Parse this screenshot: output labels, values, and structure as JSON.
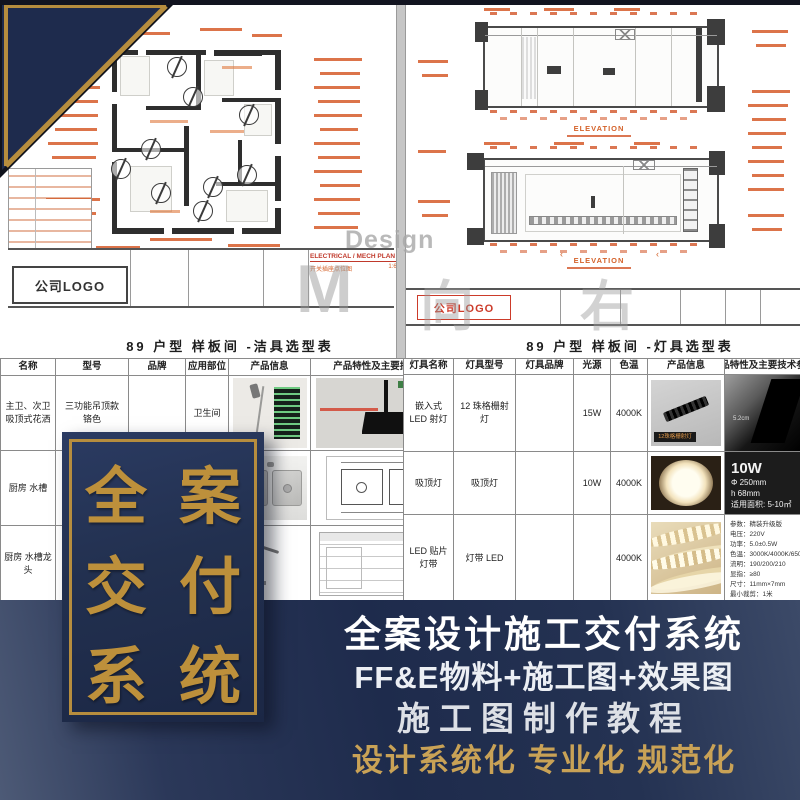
{
  "corner_banner": {
    "lines": [
      "全案",
      "交付",
      "系统"
    ],
    "navy": "#1e2b4d",
    "gold": "#bd903b"
  },
  "sheet_left": {
    "plan_title": "ELECTRICAL / MECH PLAN",
    "plan_subtitle": "开关插座点位图",
    "plan_scale": "1:60",
    "logo": "公司LOGO"
  },
  "sheet_right": {
    "elevation_label_1": "ELEVATION",
    "elevation_label_2": "ELEVATION",
    "logo": "公司LOGO"
  },
  "watermark": {
    "design": "Design",
    "glyphs": [
      "M",
      "向",
      "右"
    ]
  },
  "titles": {
    "sanitary": "89 户型 样板间 -洁具选型表",
    "lighting": "89 户型 样板间 -灯具选型表"
  },
  "sanitary_table": {
    "headers": [
      "名称",
      "型号",
      "品牌",
      "应用部位",
      "产品信息",
      "产品特性及主要技术参数"
    ],
    "rows": [
      {
        "name": "主卫、次卫 吸顶式花洒",
        "model": "三功能吊顶款 铬色",
        "brand": "",
        "location": "卫生间"
      },
      {
        "name": "厨房  水槽",
        "model": "",
        "brand": "",
        "location": ""
      },
      {
        "name": "厨房  水槽龙头",
        "model": "",
        "brand": "",
        "location": ""
      }
    ]
  },
  "lighting_table": {
    "headers": [
      "灯具名称",
      "灯具型号",
      "灯具品牌",
      "光源",
      "色温",
      "产品信息",
      "产品特性及主要技术参数"
    ],
    "rows": [
      {
        "name": "嵌入式 LED 射灯",
        "model": "12 珠格栅射灯",
        "brand": "",
        "source": "15W",
        "cct": "4000K",
        "info_caption": "12珠格栅射灯",
        "feature_caption": "5.2cm"
      },
      {
        "name": "吸顶灯",
        "model": "吸顶灯",
        "brand": "",
        "source": "10W",
        "cct": "4000K",
        "feature_specs": [
          "10W",
          "Φ 250mm",
          "h 68mm",
          "适用面积: 5-10㎡"
        ]
      },
      {
        "name": "LED 贴片灯带",
        "model": "灯带 LED",
        "brand": "",
        "source": "",
        "cct": "4000K",
        "feature_specs": [
          "参数：精装升级版",
          "电压：220V",
          "功率：5.0±0.5W",
          "色温：3000K/4000K/6500K",
          "流明：190/200/210",
          "显指：≥80",
          "尺寸：11mm×7mm",
          "最小裁剪：1米"
        ]
      }
    ]
  },
  "footer": {
    "line1": "全案设计施工交付系统",
    "line2": "FF&E物料+施工图+效果图",
    "line3": "施工图制作教程",
    "line4": "设计系统化 专业化 规范化",
    "accent_gold": "#c9a256",
    "bg_navy": "#1e2b4c"
  }
}
